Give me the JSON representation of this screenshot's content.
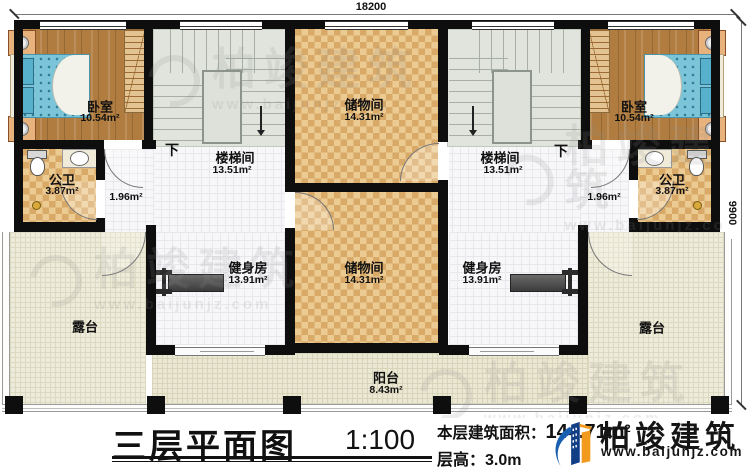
{
  "plan": {
    "title": "三层平面图",
    "scale": "1:100",
    "stats": {
      "area_label": "本层建筑面积：",
      "area_value": "144.71",
      "area_unit": "m",
      "area_sup": "2",
      "height_label": "层高：",
      "height_value": "3.0m"
    },
    "brand": {
      "name": "柏竣建筑",
      "site": "www.baijunjz.com"
    },
    "dimensions": {
      "width": "18200",
      "height": "9900"
    },
    "stair_direction": "下",
    "rooms": [
      {
        "name": "卧室",
        "area": "10.54m²"
      },
      {
        "name": "楼梯间",
        "area": "13.51m²"
      },
      {
        "name": "公卫",
        "area": "3.87m²"
      },
      {
        "name": "",
        "area": "1.96m²"
      },
      {
        "name": "储物间",
        "area": "14.31m²"
      },
      {
        "name": "健身房",
        "area": "13.91m²"
      },
      {
        "name": "储物间",
        "area": "14.31m²"
      },
      {
        "name": "露台",
        "area": ""
      },
      {
        "name": "卧室",
        "area": "10.54m²"
      },
      {
        "name": "楼梯间",
        "area": "13.51m²"
      },
      {
        "name": "公卫",
        "area": "3.87m²"
      },
      {
        "name": "",
        "area": "1.96m²"
      },
      {
        "name": "健身房",
        "area": "13.91m²"
      },
      {
        "name": "露台",
        "area": ""
      },
      {
        "name": "阳台",
        "area": "8.43m²"
      }
    ],
    "watermark": {
      "brand": "柏竣建筑",
      "site": "www.baijunjz.com"
    }
  }
}
